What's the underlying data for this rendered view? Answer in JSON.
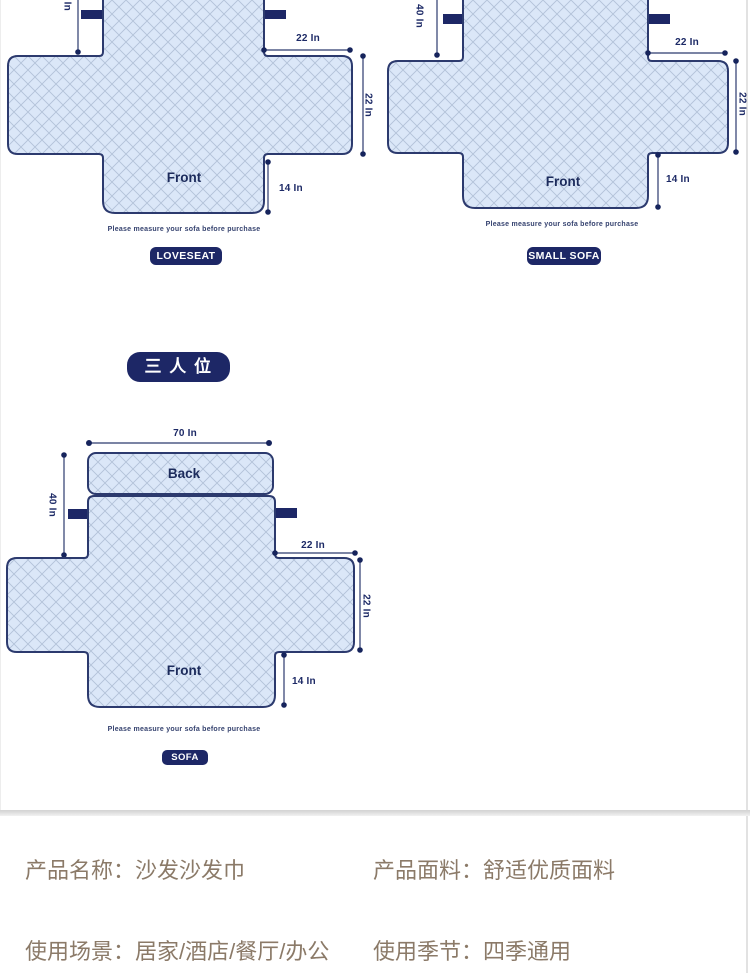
{
  "section_labels": {
    "three_seater_badge": "三 人 位"
  },
  "badges": {
    "loveseat": "LOVESEAT",
    "small_sofa": "SMALL SOFA",
    "sofa": "SOFA"
  },
  "dims": {
    "loveseat": {
      "back_height": "40 In",
      "arm_top_width": "22 In",
      "arm_side_height": "22 In",
      "front_height": "14 In",
      "front_label": "Front",
      "note": "Please measure your sofa before purchase"
    },
    "small_sofa": {
      "back_height": "40 In",
      "arm_top_width": "22 In",
      "arm_side_height": "22 In",
      "front_height": "14 In",
      "front_label": "Front",
      "note": "Please measure your sofa before purchase"
    },
    "sofa": {
      "total_width": "70 In",
      "back_label": "Back",
      "back_height": "40 In",
      "arm_top_width": "22 In",
      "arm_side_height": "22 In",
      "front_height": "14 In",
      "front_label": "Front",
      "note": "Please measure your sofa before purchase"
    }
  },
  "product_info": {
    "rows": [
      {
        "label": "产品名称：",
        "value": "沙发沙发巾"
      },
      {
        "label": "产品面料：",
        "value": "舒适优质面料"
      },
      {
        "label": "使用场景：",
        "value": "居家/酒店/餐厅/办公"
      },
      {
        "label": "使用季节：",
        "value": "四季通用"
      }
    ]
  },
  "colors": {
    "navy": "#1d2766",
    "outline_navy": "#2c3a6e",
    "cover_fill": "#dbe7f8",
    "lattice_line": "#b3c2d8",
    "info_text": "#8b7a68",
    "divider": "#d3d3d3"
  }
}
